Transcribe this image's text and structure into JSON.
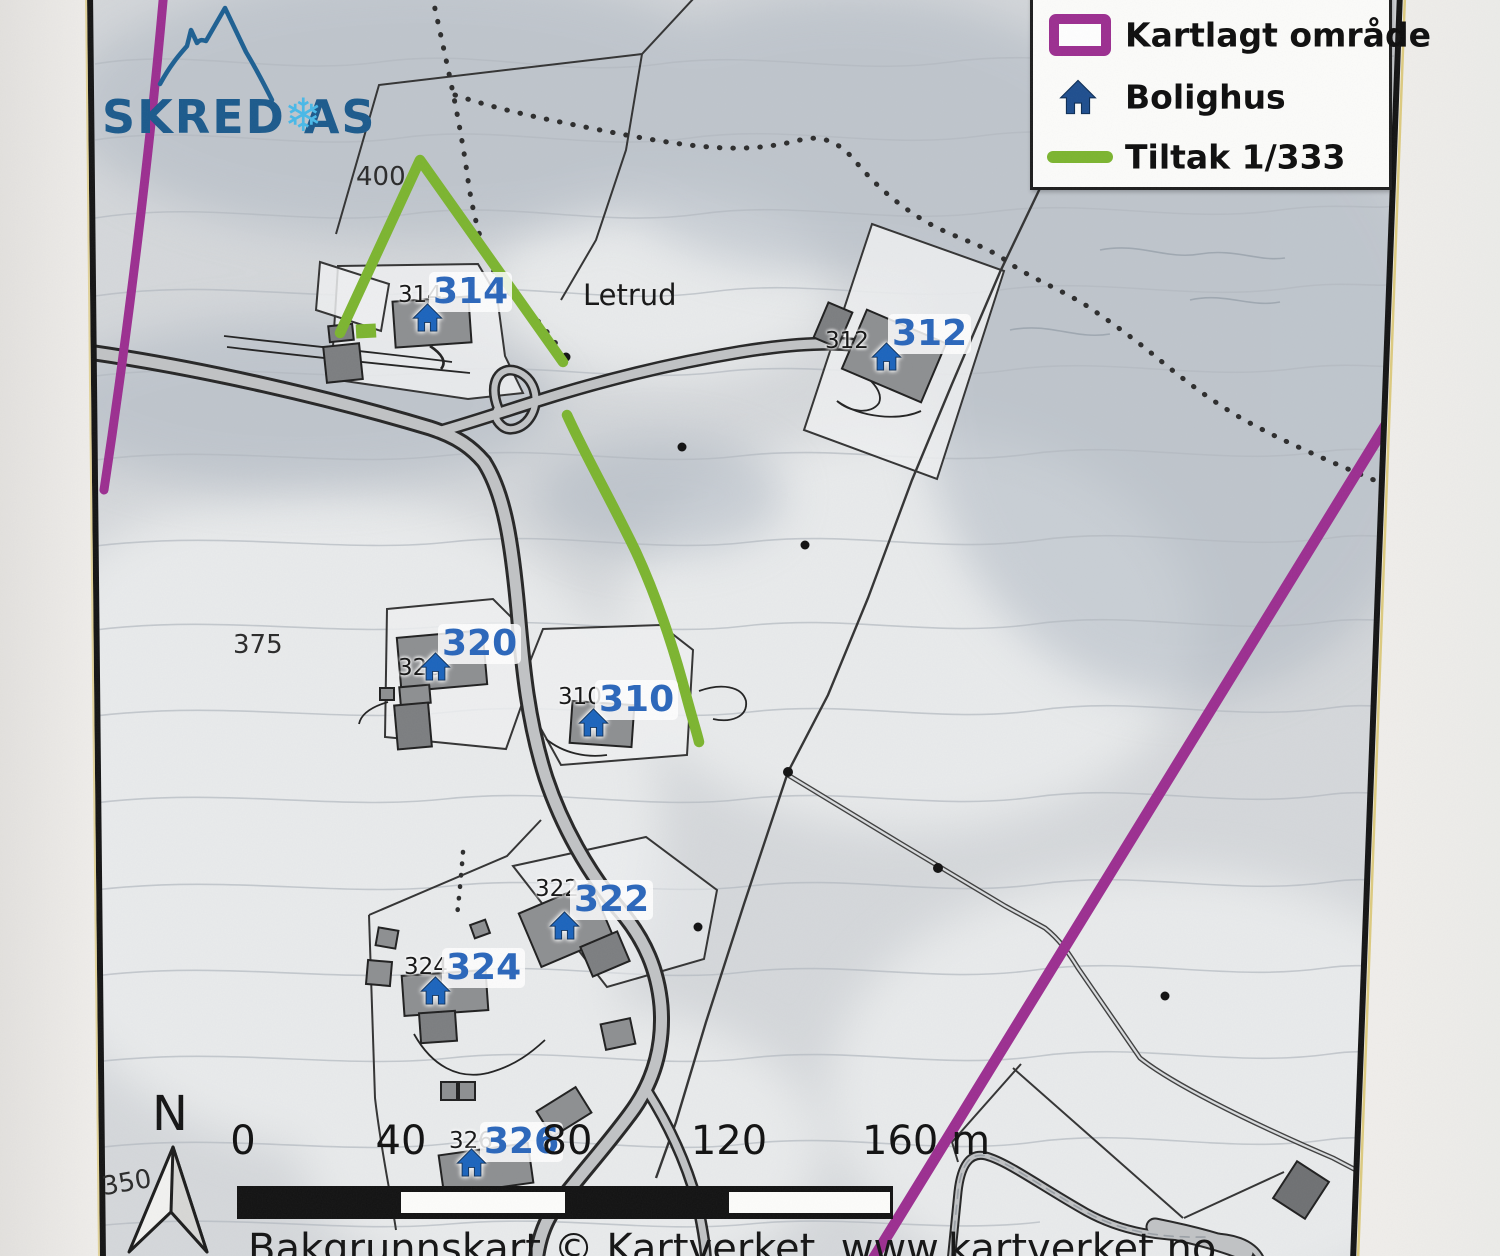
{
  "logo": {
    "company_name": "SKRED AS",
    "snowflake_glyph": "❄"
  },
  "legend": {
    "items": [
      {
        "id": "kartlagt-omrade",
        "label": "Kartlagt område",
        "swatch": "purple-rectangle-outline",
        "color": "#9c2e90"
      },
      {
        "id": "bolighus",
        "label": "Bolighus",
        "swatch": "house-icon",
        "color": "#1e4e8e"
      },
      {
        "id": "tiltak",
        "label": "Tiltak 1/333",
        "swatch": "green-line",
        "color": "#7cb52f"
      }
    ]
  },
  "map": {
    "place_label": "Letrud",
    "contour_labels": [
      {
        "text": "400"
      },
      {
        "text": "375"
      },
      {
        "text": "350"
      }
    ],
    "houses": [
      {
        "id": "314",
        "small_label": "314",
        "big_label": "314"
      },
      {
        "id": "312",
        "small_label": "312",
        "big_label": "312"
      },
      {
        "id": "320",
        "small_label": "320",
        "big_label": "320"
      },
      {
        "id": "310",
        "small_label": "310",
        "big_label": "310"
      },
      {
        "id": "322",
        "small_label": "322",
        "big_label": "322"
      },
      {
        "id": "324",
        "small_label": "324",
        "big_label": "324"
      },
      {
        "id": "326",
        "small_label": "326",
        "big_label": "326"
      }
    ]
  },
  "scalebar": {
    "ticks": [
      {
        "label": "0"
      },
      {
        "label": "40"
      },
      {
        "label": "80"
      },
      {
        "label": "120"
      },
      {
        "label": "160 m"
      }
    ]
  },
  "compass": {
    "north_label": "N"
  },
  "credit": {
    "text": "Bakgrunnskart © Kartverket, www.kartverket.no"
  },
  "colors": {
    "mapped_area_purple": "#9c2e90",
    "tiltak_green": "#7cb52f",
    "house_icon_blue": "#1b64bd",
    "house_label_blue": "#2a66bb",
    "legend_house_navy": "#1e4e8e",
    "logo_blue": "#1b5a8c",
    "snowflake_blue": "#49b9e8"
  }
}
